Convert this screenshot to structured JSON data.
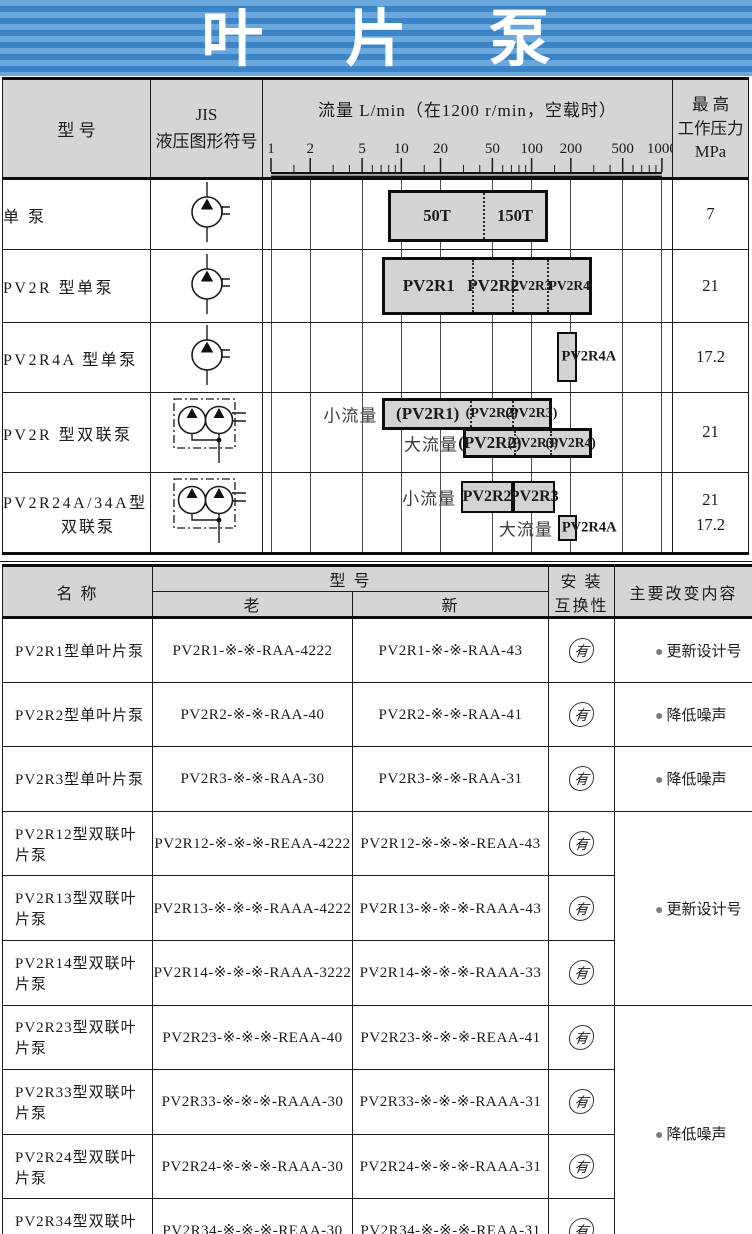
{
  "title": {
    "text": "叶 片 泵"
  },
  "colors": {
    "banner_light": "#69a7dc",
    "banner_dark": "#3c84c8",
    "header_bg": "#d5d5d5",
    "bar_fill": "#d3d3d3",
    "border": "#1a1a1a",
    "bullet_gray": "#7d7d7d"
  },
  "table1": {
    "header": {
      "model": "型    号",
      "jis_line1": "JIS",
      "jis_line2": "液压图形符号",
      "pressure_lines": [
        "最    高",
        "工作压力",
        "MPa"
      ]
    }
  },
  "chart_data": {
    "type": "bar",
    "title": "流量  L/min（在1200 r/min，空载时）",
    "xlabel": "流量 L/min",
    "axis": {
      "scale": "log",
      "min": 1,
      "max": 1000,
      "ticks": [
        1,
        2,
        5,
        10,
        20,
        50,
        100,
        200,
        500,
        1000
      ]
    },
    "rows": [
      {
        "model": [
          "单 泵"
        ],
        "symbol": "single",
        "pressure": [
          "7"
        ],
        "bars": [
          {
            "boxes": [
              {
                "from": 8,
                "to": 136,
                "segments": [
                  {
                    "label": "50T",
                    "from": 8,
                    "to": 43,
                    "fs": 16.5
                  },
                  {
                    "label": "150T",
                    "from": 43,
                    "to": 136,
                    "fs": 16.5
                  }
                ]
              }
            ]
          }
        ]
      },
      {
        "model": [
          "PV2R 型单泵"
        ],
        "symbol": "single",
        "pressure": [
          "21"
        ],
        "bars": [
          {
            "boxes": [
              {
                "from": 7.2,
                "to": 296,
                "segments": [
                  {
                    "label": "PV2R1",
                    "from": 7.2,
                    "to": 35,
                    "fs": 17
                  },
                  {
                    "label": "PV2R2",
                    "from": 35,
                    "to": 73,
                    "fs": 17
                  },
                  {
                    "label": "PV2R3",
                    "from": 73,
                    "to": 138,
                    "fs": 13.5
                  },
                  {
                    "label": "PV2R4",
                    "from": 138,
                    "to": 296,
                    "fs": 13.5
                  }
                ]
              }
            ]
          }
        ]
      },
      {
        "model": [
          "PV2R4A 型单泵"
        ],
        "symbol": "single",
        "pressure": [
          "17.2"
        ],
        "bars": [
          {
            "boxes": [
              {
                "from": 160,
                "to": 227,
                "outside_label": "PV2R4A",
                "segments": []
              }
            ]
          }
        ]
      },
      {
        "model": [
          "PV2R 型双联泵"
        ],
        "symbol": "double",
        "pressure": [
          "21"
        ],
        "bars": [
          {
            "prefix": "小流量",
            "boxes": [
              {
                "from": 7.2,
                "to": 146,
                "segments": [
                  {
                    "label": "(PV2R1)",
                    "from": 7.2,
                    "to": 34,
                    "fs": 17
                  },
                  {
                    "label": "(PV2R2)",
                    "from": 34,
                    "to": 73,
                    "fs": 14
                  },
                  {
                    "label": "(PV2R3)",
                    "from": 73,
                    "to": 146,
                    "fs": 14
                  }
                ]
              }
            ]
          },
          {
            "prefix": "大流量",
            "boxes": [
              {
                "from": 30,
                "to": 296,
                "segments": [
                  {
                    "label": "(PV2R2)",
                    "from": 30,
                    "to": 73,
                    "fs": 17
                  },
                  {
                    "label": "(PV2R3)",
                    "from": 73,
                    "to": 143,
                    "fs": 13.5
                  },
                  {
                    "label": "(PV2R4)",
                    "from": 143,
                    "to": 296,
                    "fs": 13.5
                  }
                ]
              }
            ]
          }
        ]
      },
      {
        "model": [
          "PV2R24A/34A型",
          "双联泵"
        ],
        "symbol": "double",
        "pressure": [
          "21",
          "17.2"
        ],
        "bars": [
          {
            "prefix": "小流量",
            "boxes": [
              {
                "from": 29,
                "to": 73,
                "segments": [
                  {
                    "label": "PV2R2",
                    "from": 29,
                    "to": 73,
                    "fs": 16
                  }
                ]
              },
              {
                "from": 73,
                "to": 154,
                "segments": [
                  {
                    "label": "PV2R3",
                    "from": 73,
                    "to": 154,
                    "fs": 16
                  }
                ]
              }
            ]
          },
          {
            "prefix": "大流量",
            "boxes": [
              {
                "from": 161,
                "to": 227,
                "outside_label": "PV2R4A",
                "segments": []
              }
            ]
          }
        ]
      }
    ]
  },
  "table2": {
    "header": {
      "name": "名  称",
      "model": "型    号",
      "old": "老",
      "new": "新",
      "compat_line1": "安  装",
      "compat_line2": "互换性",
      "changes": "主要改变内容"
    },
    "compat_mark": "有",
    "bullet": "●",
    "rows": [
      {
        "name": "PV2R1型单叶片泵",
        "old": "PV2R1-※-※-RAA-4222",
        "new": "PV2R1-※-※-RAA-43",
        "compat": "有",
        "change": "更新设计号",
        "change_span": 1
      },
      {
        "name": "PV2R2型单叶片泵",
        "old": "PV2R2-※-※-RAA-40",
        "new": "PV2R2-※-※-RAA-41",
        "compat": "有",
        "change": "降低噪声",
        "change_span": 1
      },
      {
        "name": "PV2R3型单叶片泵",
        "old": "PV2R3-※-※-RAA-30",
        "new": "PV2R3-※-※-RAA-31",
        "compat": "有",
        "change": "降低噪声",
        "change_span": 1
      },
      {
        "name": "PV2R12型双联叶片泵",
        "old": "PV2R12-※-※-※-REAA-4222",
        "new": "PV2R12-※-※-※-REAA-43",
        "compat": "有",
        "change": "更新设计号",
        "change_span": 3
      },
      {
        "name": "PV2R13型双联叶片泵",
        "old": "PV2R13-※-※-※-RAAA-4222",
        "new": "PV2R13-※-※-※-RAAA-43",
        "compat": "有"
      },
      {
        "name": "PV2R14型双联叶片泵",
        "old": "PV2R14-※-※-※-RAAA-3222",
        "new": "PV2R14-※-※-※-RAAA-33",
        "compat": "有"
      },
      {
        "name": "PV2R23型双联叶片泵",
        "old": "PV2R23-※-※-※-REAA-40",
        "new": "PV2R23-※-※-※-REAA-41",
        "compat": "有",
        "change": "降低噪声",
        "change_span": 4
      },
      {
        "name": "PV2R33型双联叶片泵",
        "old": "PV2R33-※-※-※-RAAA-30",
        "new": "PV2R33-※-※-※-RAAA-31",
        "compat": "有"
      },
      {
        "name": "PV2R24型双联叶片泵",
        "old": "PV2R24-※-※-※-RAAA-30",
        "new": "PV2R24-※-※-※-RAAA-31",
        "compat": "有"
      },
      {
        "name": "PV2R34型双联叶片泵",
        "old": "PV2R34-※-※-※-REAA-30",
        "new": "PV2R34-※-※-※-REAA-31",
        "compat": "有"
      }
    ]
  }
}
